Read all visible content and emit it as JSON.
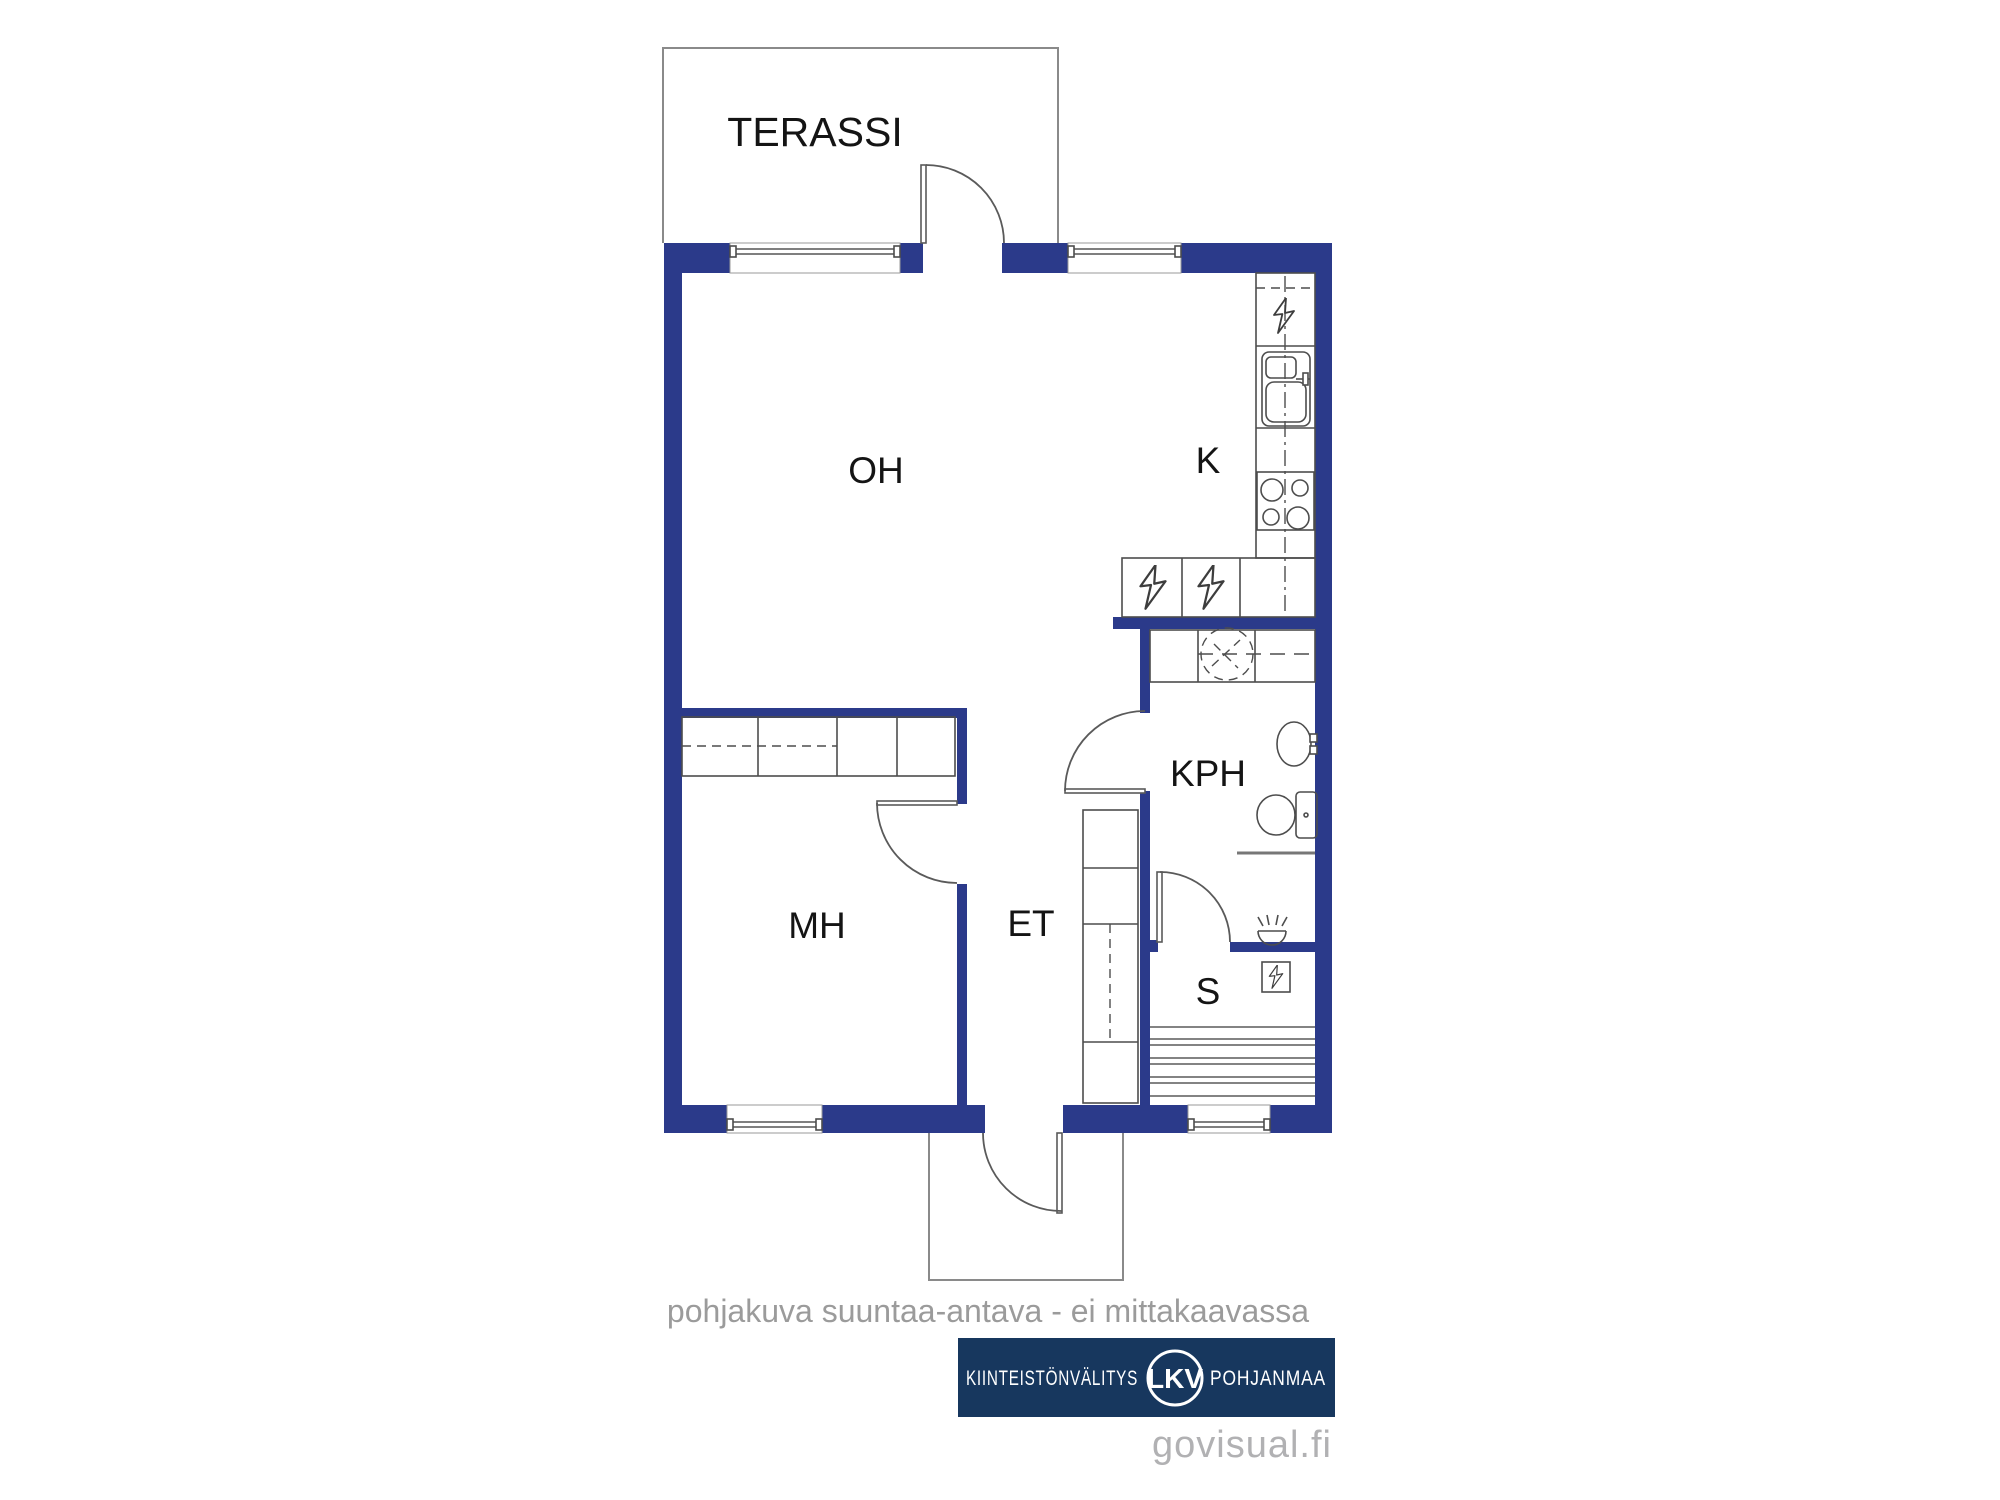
{
  "plan": {
    "rooms": [
      {
        "id": "terassi",
        "label": "TERASSI"
      },
      {
        "id": "oh",
        "label": "OH"
      },
      {
        "id": "k",
        "label": "K"
      },
      {
        "id": "mh",
        "label": "MH"
      },
      {
        "id": "et",
        "label": "ET"
      },
      {
        "id": "kph",
        "label": "KPH"
      },
      {
        "id": "s",
        "label": "S"
      }
    ],
    "icons": [
      "lightning-icon",
      "sink-icon",
      "stove-icon",
      "washing-machine-icon",
      "washbasin-icon",
      "toilet-icon",
      "shower-icon",
      "sauna-heater-icon",
      "sauna-bench-icon",
      "window-icon",
      "door-arc-icon"
    ],
    "colors": {
      "wall_blue": "#2b3a8a",
      "logo_navy": "#17375e",
      "caption_gray": "#9b9b9b",
      "watermark_gray": "#b1b1b3",
      "line_gray": "#4d4d4d"
    }
  },
  "caption": {
    "text": "pohjakuva suuntaa-antava - ei mittakaavassa"
  },
  "footer": {
    "brand_left": "KIINTEISTÖNVÄLITYS",
    "brand_badge": "LKV",
    "brand_right": "POHJANMAA",
    "watermark": "govisual.fi"
  }
}
